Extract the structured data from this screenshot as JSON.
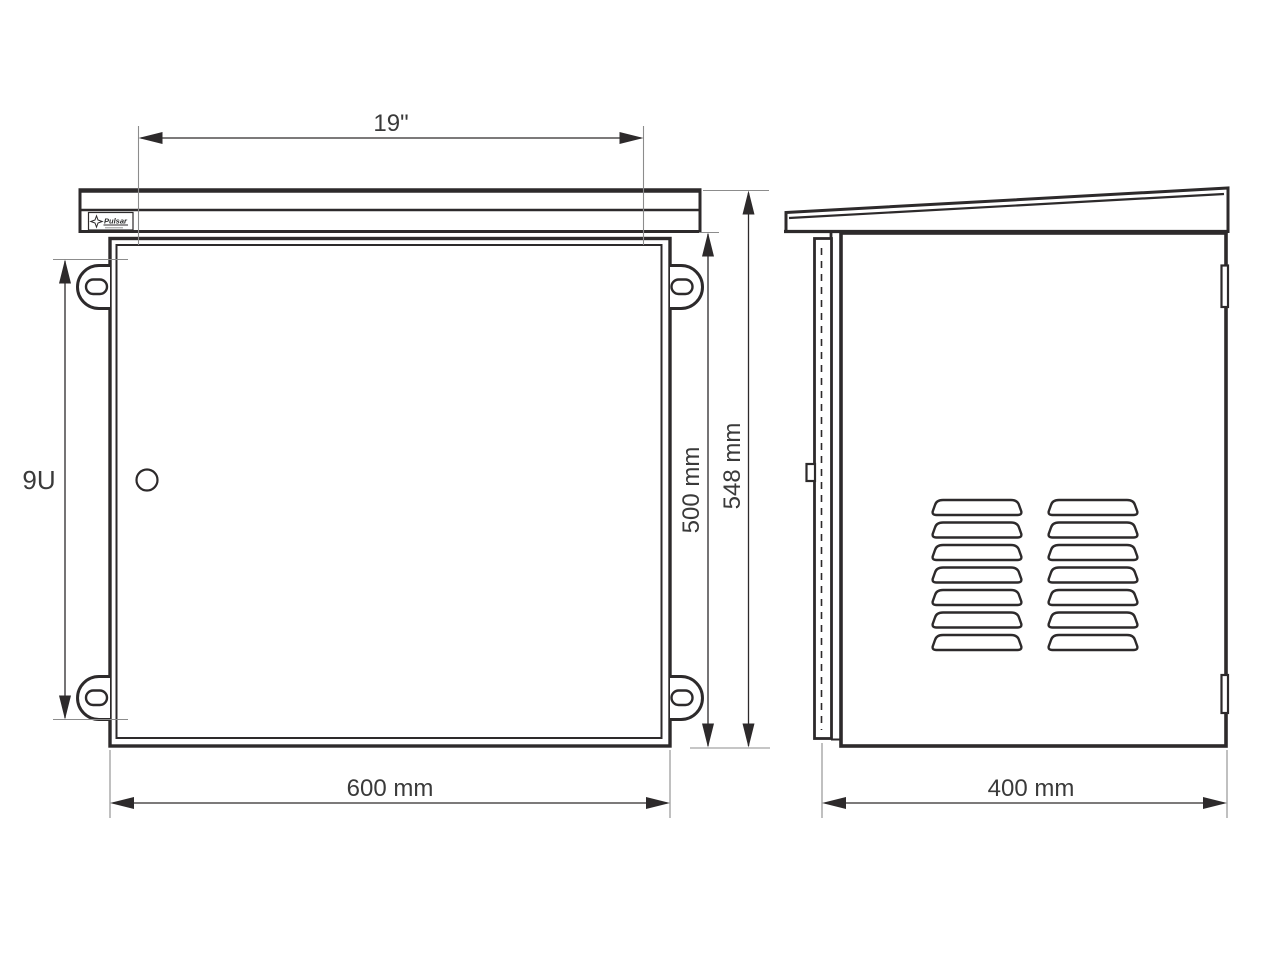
{
  "logo": {
    "text": "Pulsar"
  },
  "dimensions": {
    "rack_width": {
      "label": "19\""
    },
    "rack_units": {
      "label": "9U"
    },
    "door_height": {
      "label": "500 mm"
    },
    "total_height": {
      "label": "548 mm"
    },
    "overall_width": {
      "label": "600 mm"
    },
    "overall_depth": {
      "label": "400 mm"
    }
  },
  "colors": {
    "line": "#2d2a2b",
    "extension_line": "#8c8c8c",
    "text": "#3a3a3a",
    "background": "#ffffff"
  }
}
